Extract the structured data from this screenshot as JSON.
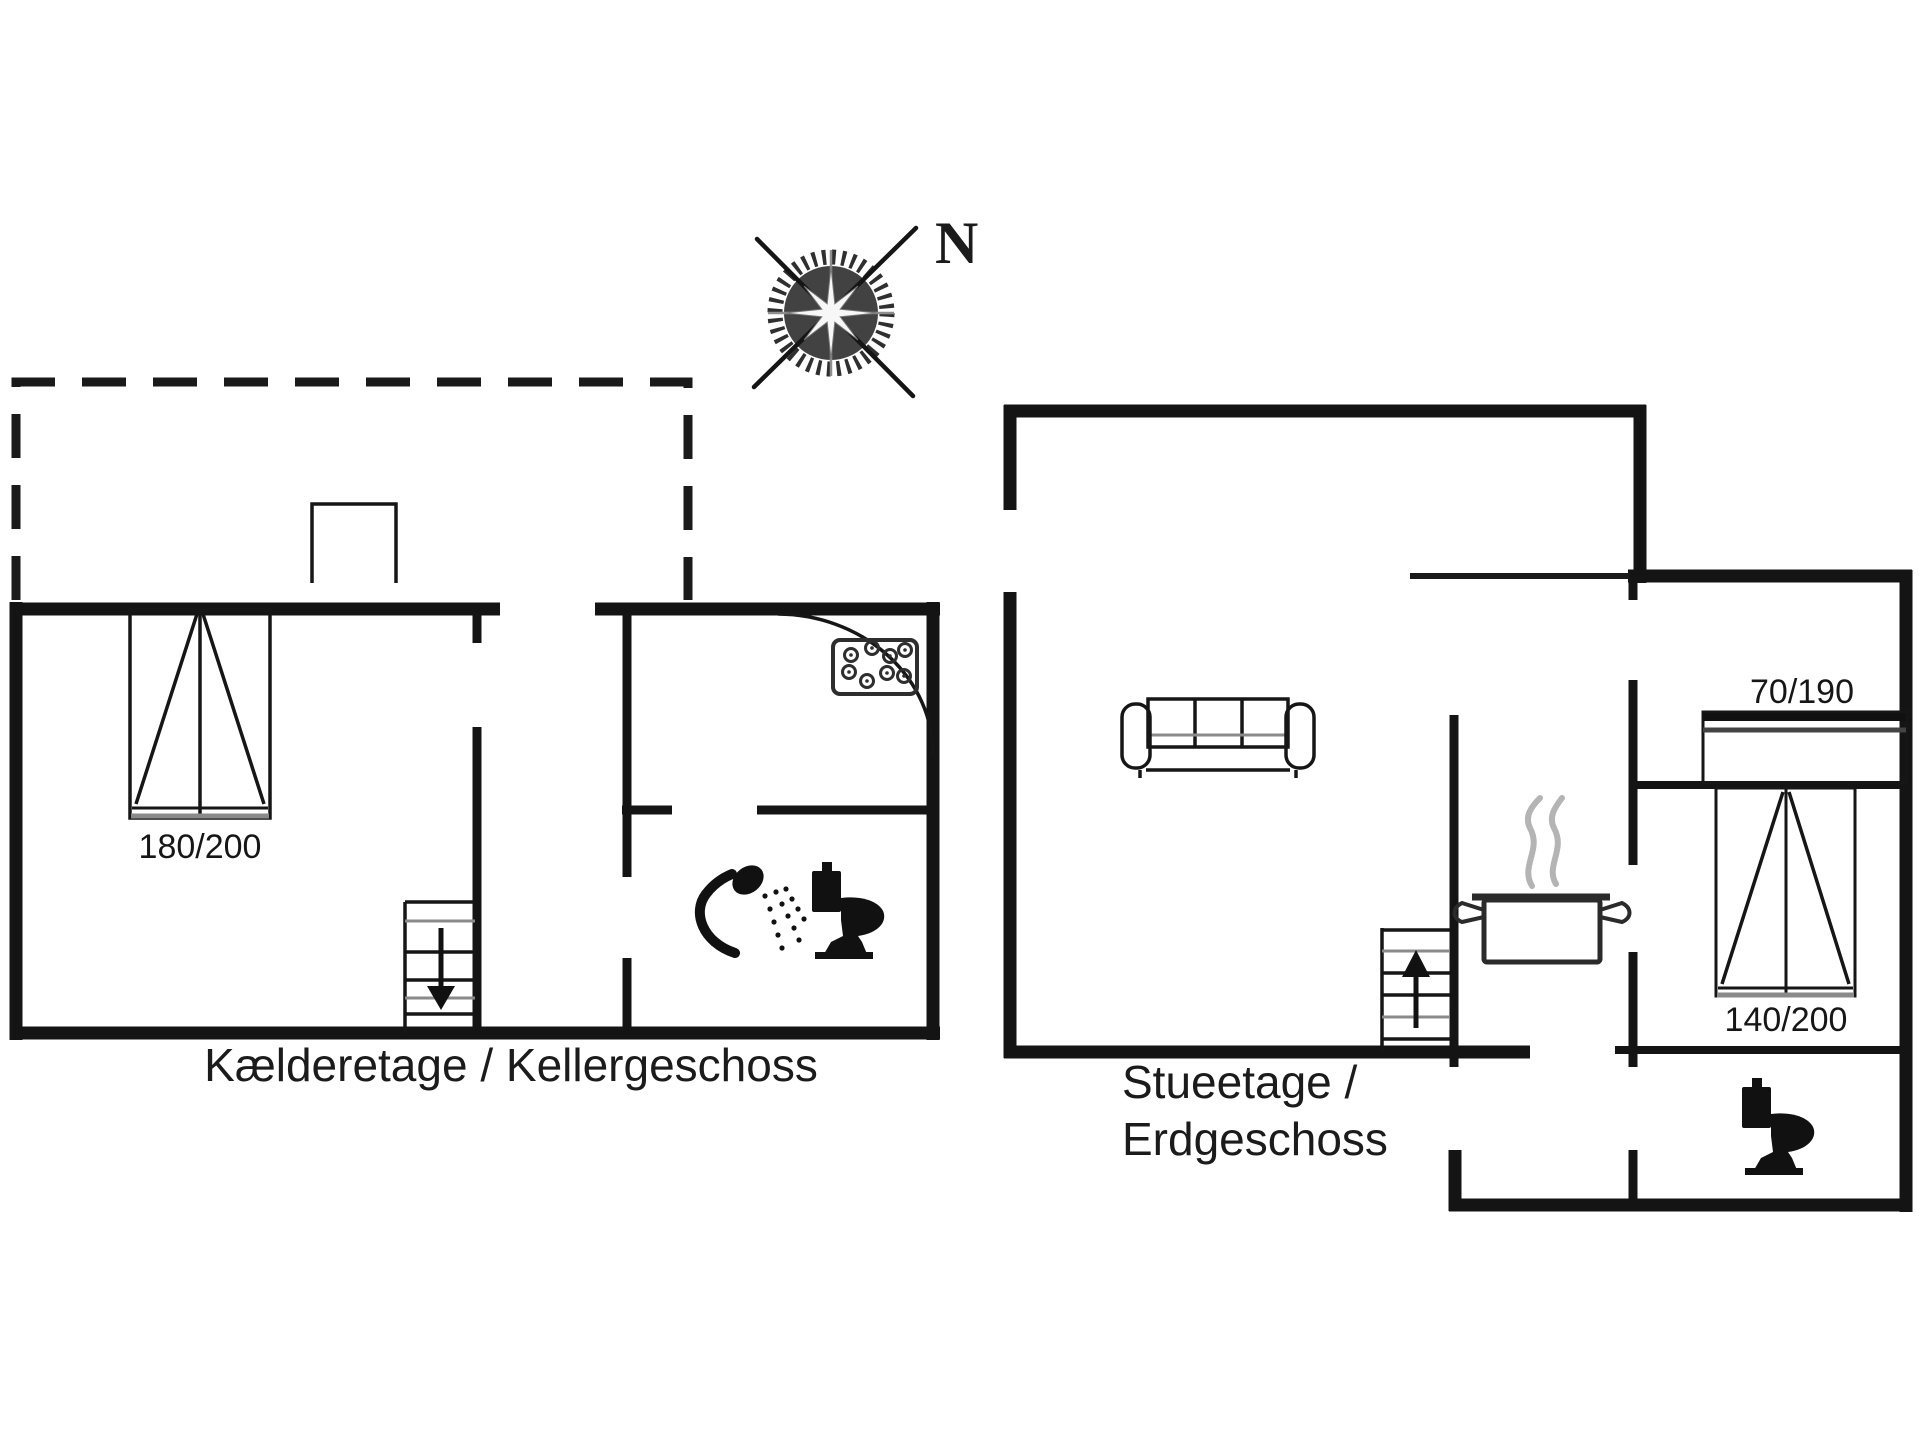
{
  "colors": {
    "background": "#ffffff",
    "line": "#141414",
    "secondary_gray": "#8a8a8a",
    "steam_gray": "#b4b4b4"
  },
  "compass": {
    "north_label": "N"
  },
  "basement": {
    "caption": "Kælderetage / Kellergeschoss",
    "double_bed_label": "180/200"
  },
  "ground_floor": {
    "caption_line1": "Stueetage /",
    "caption_line2": "Erdgeschoss",
    "single_bed_label": "70/190",
    "double_bed_label": "140/200"
  }
}
